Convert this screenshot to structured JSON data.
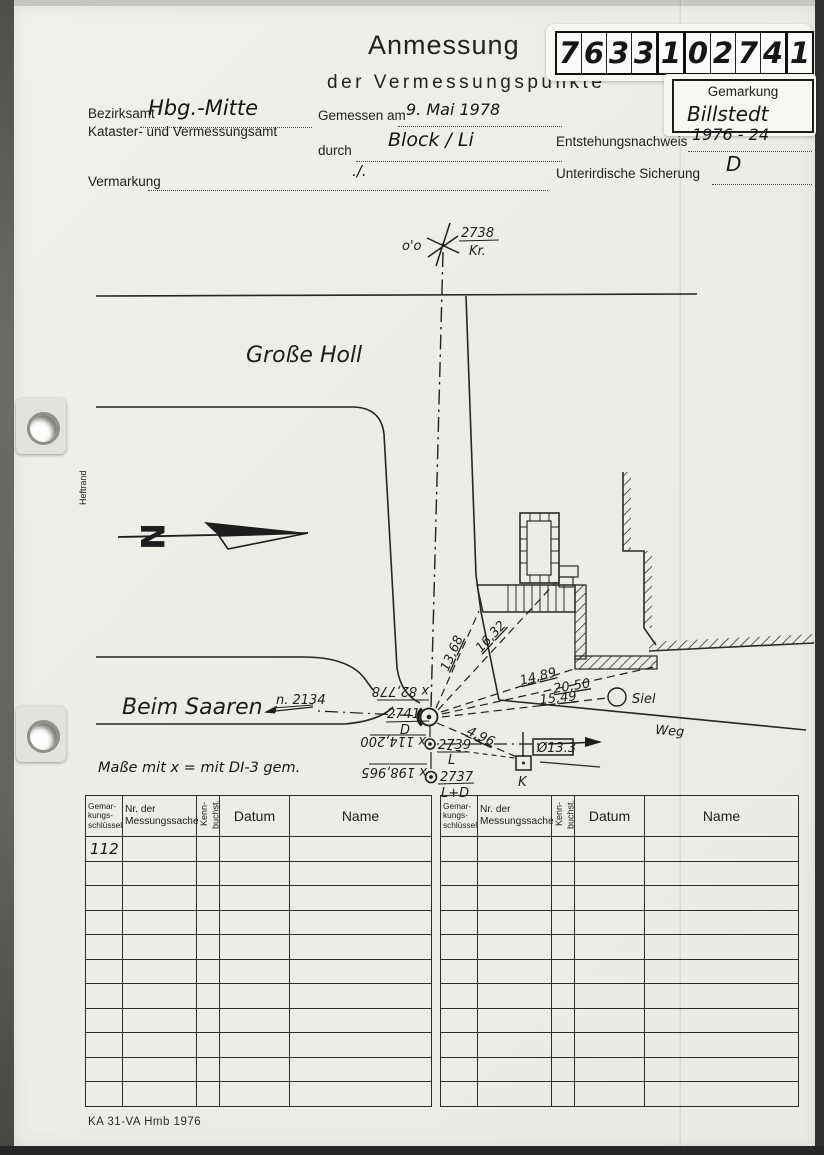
{
  "header": {
    "title": "Anmessung",
    "subtitle": "der Vermessungspunkte",
    "point_id": [
      "7",
      "6",
      "3",
      "3",
      "1",
      "0",
      "2",
      "7",
      "4",
      "1"
    ],
    "gemarkung_label": "Gemarkung",
    "gemarkung_value": "Billstedt"
  },
  "fields": {
    "bezirksamt": {
      "label": "Bezirksamt",
      "value": "Hbg.-Mitte"
    },
    "amt_label": "Kataster- und Vermessungsamt",
    "gemessen": {
      "label": "Gemessen am",
      "value": "9. Mai 1978"
    },
    "durch": {
      "label": "durch",
      "value": "Block / Li"
    },
    "vermarkung": {
      "label": "Vermarkung",
      "value": "./."
    },
    "entstehung": {
      "label": "Entstehungsnachweis",
      "value": "1976 - 24"
    },
    "sicherung": {
      "label": "Unterirdische Sicherung",
      "value": "D"
    }
  },
  "sketch": {
    "heftrand": "Heftrand",
    "north": "N",
    "streets": {
      "grosse_holl": "Große Holl",
      "beim_saaren": "Beim Saaren",
      "weg": "Weg"
    },
    "oo": "o'o",
    "ref_point": "n. 2134",
    "points": {
      "p2738": {
        "id": "2738",
        "sub": "Kr."
      },
      "p2741": {
        "id": "2741",
        "sub": "D",
        "coord": "x 82,778"
      },
      "p2739": {
        "id": "2739",
        "sub": "L",
        "coord": "x 114,200"
      },
      "p2737": {
        "id": "2737",
        "sub": "L+D",
        "coord": "x 198,965"
      }
    },
    "measurements": [
      "13,68",
      "16,32",
      "14,89",
      "20,50",
      "15,49",
      "4,96"
    ],
    "siel": "Siel",
    "k": "K",
    "box_value": "Ø13.3",
    "note": "Maße mit x  = mit DI-3 gem."
  },
  "table": {
    "headers": [
      "Gemar-\nkungs-\nschlüssel",
      "Nr. der\nMessungssache",
      "Kenn-\nbuchst.",
      "Datum",
      "Name"
    ],
    "first_cell": "112"
  },
  "footer": {
    "text": "KA 31-VA Hmb 1976"
  }
}
